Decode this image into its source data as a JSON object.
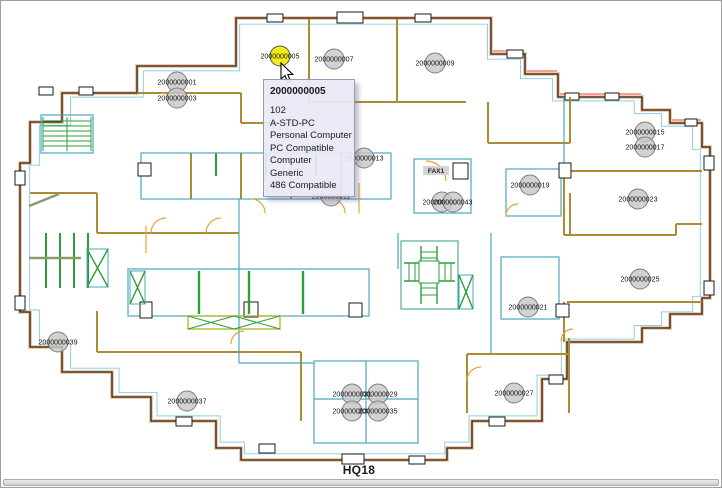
{
  "app": {
    "floor_label": "HQ18"
  },
  "tooltip": {
    "asset_id": "2000000005",
    "lines": [
      "102",
      "A-STD-PC",
      "Personal Computer",
      "PC Compatible",
      "Computer",
      "Generic",
      "486 Compatible"
    ]
  },
  "plan": {
    "equipment_text_labels": [
      {
        "text": "FAX1",
        "x": 435,
        "y": 172
      }
    ],
    "markers": [
      {
        "id": "2000000001",
        "x": 176,
        "y": 81,
        "selected": false
      },
      {
        "id": "2000000003",
        "x": 176,
        "y": 97,
        "selected": false
      },
      {
        "id": "2000000005",
        "x": 279,
        "y": 55,
        "selected": true
      },
      {
        "id": "2000000007",
        "x": 333,
        "y": 58,
        "selected": false
      },
      {
        "id": "2000000009",
        "x": 434,
        "y": 62,
        "selected": false
      },
      {
        "id": "2000000011",
        "x": 330,
        "y": 195,
        "selected": false
      },
      {
        "id": "2000000013",
        "x": 363,
        "y": 157,
        "selected": false
      },
      {
        "id": "2000000015",
        "x": 644,
        "y": 131,
        "selected": false
      },
      {
        "id": "2000000017",
        "x": 644,
        "y": 146,
        "selected": false
      },
      {
        "id": "2000000019",
        "x": 529,
        "y": 184,
        "selected": false
      },
      {
        "id": "2000000021",
        "x": 527,
        "y": 306,
        "selected": false
      },
      {
        "id": "2000000023",
        "x": 637,
        "y": 198,
        "selected": false
      },
      {
        "id": "2000000025",
        "x": 639,
        "y": 278,
        "selected": false
      },
      {
        "id": "2000000027",
        "x": 513,
        "y": 392,
        "selected": false
      },
      {
        "id": "2000000029",
        "x": 377,
        "y": 393,
        "selected": false
      },
      {
        "id": "2000000031",
        "x": 351,
        "y": 393,
        "selected": false
      },
      {
        "id": "2000000033",
        "x": 351,
        "y": 410,
        "selected": false
      },
      {
        "id": "2000000035",
        "x": 377,
        "y": 410,
        "selected": false
      },
      {
        "id": "2000000037",
        "x": 186,
        "y": 400,
        "selected": false
      },
      {
        "id": "2000000039",
        "x": 57,
        "y": 341,
        "selected": false
      },
      {
        "id": "2000000041",
        "x": 441,
        "y": 201,
        "selected": false
      },
      {
        "id": "2000000043",
        "x": 452,
        "y": 201,
        "selected": false
      }
    ]
  },
  "colors": {
    "selected_marker": "#f4ec1a",
    "marker_fill": "#c8c8c8",
    "marker_stroke": "#7d7d7d",
    "wall_tan": "#ab8c33",
    "line_cyan": "#4aa8c0",
    "inner_cyan": "#8ecfdf",
    "line_green": "#2e9e3a",
    "line_peach": "#f5cba7",
    "window_red": "#e96a56",
    "door_orange": "#e8a33d",
    "tooltip_bg": "#e9e9f8"
  }
}
